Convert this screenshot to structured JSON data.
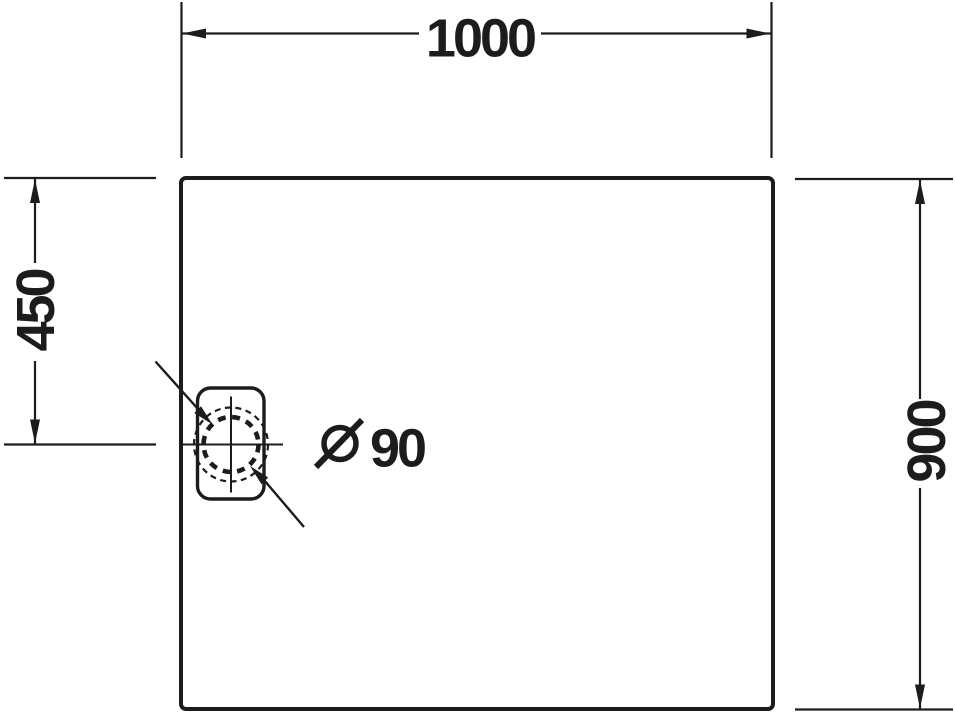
{
  "drawing": {
    "colors": {
      "ink": "#1c1c1c",
      "background": "#ffffff"
    }
  },
  "labels": {
    "width": "1000",
    "drain_offset": "450",
    "depth": "900",
    "drain_diameter_value": "90",
    "diameter_symbol": "Ø",
    "drain_diameter_full": "Ø 90"
  },
  "icons": {
    "diameter-symbol-icon": "Ø"
  }
}
